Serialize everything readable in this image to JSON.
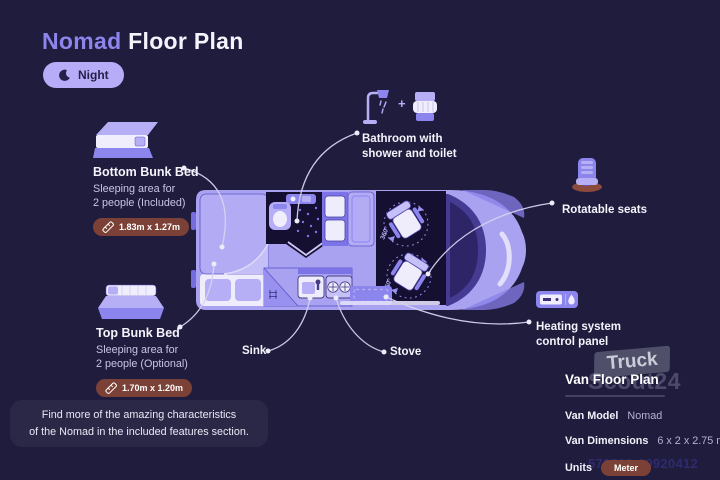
{
  "header": {
    "title_accent": "Nomad",
    "title_rest": "Floor Plan",
    "mode_badge": {
      "icon": "moon-icon",
      "label": "Night"
    }
  },
  "callouts": {
    "bottom_bunk": {
      "icon": "bunk-bed-icon",
      "title": "Bottom Bunk Bed",
      "description_line1": "Sleeping area for",
      "description_line2": "2 people (Included)",
      "dimensions_badge": {
        "icon": "ruler-icon",
        "label": "1.83m x 1.27m"
      }
    },
    "top_bunk": {
      "icon": "bunk-bed-icon",
      "title": "Top Bunk Bed",
      "description_line1": "Sleeping area for",
      "description_line2": "2 people (Optional)",
      "dimensions_badge": {
        "icon": "ruler-icon",
        "label": "1.70m x 1.20m"
      }
    },
    "bathroom": {
      "icons": [
        "shower-icon",
        "toilet-icon"
      ],
      "plus_sign": "+",
      "label_line1": "Bathroom with",
      "label_line2": "shower and toilet"
    },
    "rotatable_seats": {
      "icon": "swivel-seat-icon",
      "label": "Rotatable seats"
    },
    "heating": {
      "icon": "heating-panel-icon",
      "label_line1": "Heating system",
      "label_line2": "control panel"
    },
    "sink": {
      "label": "Sink"
    },
    "stove": {
      "label": "Stove"
    }
  },
  "floorplan": {
    "rotation_labels": [
      "360°",
      "360°"
    ]
  },
  "footer_note": {
    "line1": "Find more of the amazing characteristics",
    "line2": "of the Nomad in the included features section."
  },
  "details_panel": {
    "title": "Van Floor Plan",
    "rows": [
      {
        "label": "Van Model",
        "value": "Nomad"
      },
      {
        "label": "Van Dimensions",
        "value": "6 x 2 x 2.75 m"
      },
      {
        "label": "Units",
        "value": "Meter"
      }
    ]
  },
  "watermark": {
    "brand_top": "Truck",
    "brand_bottom": "Scout24",
    "id_text": "573580-20920412"
  },
  "colors": {
    "background": "#201c3d",
    "accent_purple": "#8d85ec",
    "van_body": "#a9a2f0",
    "interior_dark": "#150f32",
    "night_badge_bg": "#b7acf8",
    "dimension_badge_bg": "#7c4136",
    "text_primary": "#f4f3fb",
    "text_secondary": "#c9c5e6",
    "leader_line": "#d6d3f0"
  }
}
